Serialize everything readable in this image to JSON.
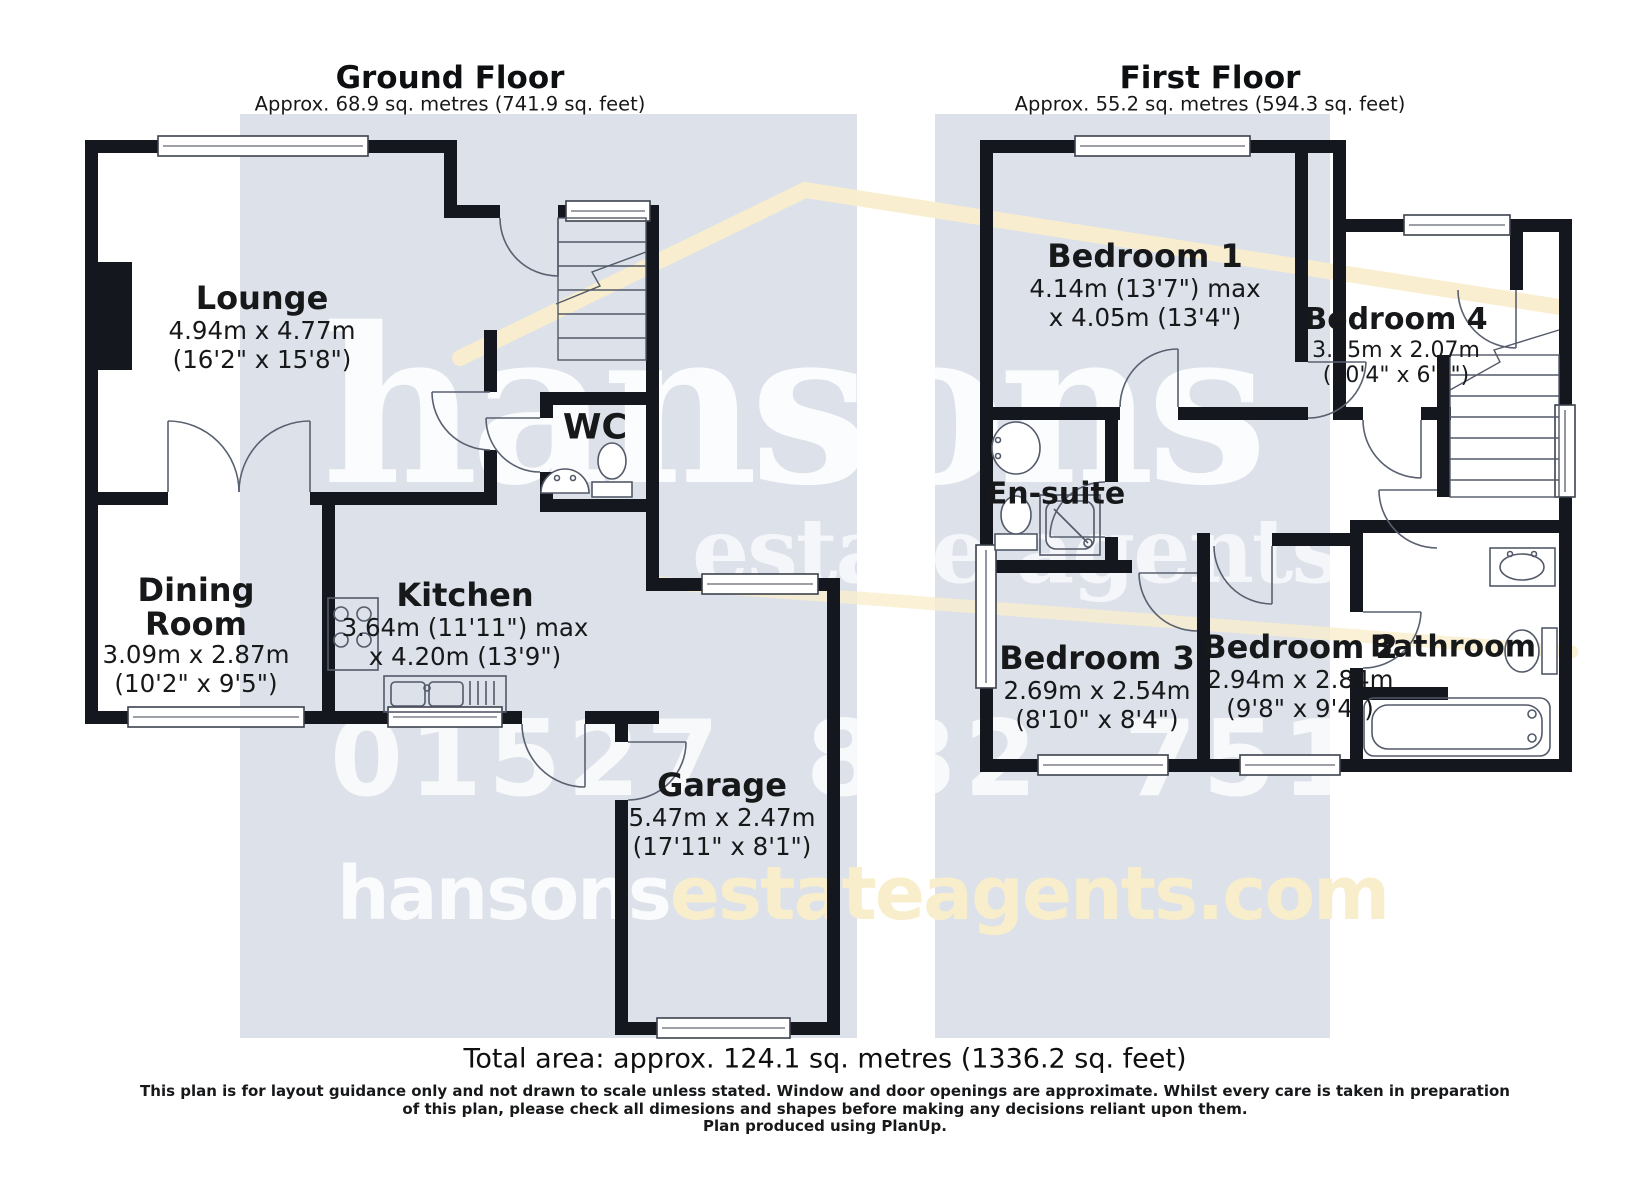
{
  "colors": {
    "wall": "#14171d",
    "plan_background": "#dce1ea",
    "watermark_cream": "#f9eecd",
    "watermark_white": "#ffffff",
    "text": "#17181a"
  },
  "watermark": {
    "brand": "hansons",
    "tagline": "estate agents",
    "phone": "01527 832 751",
    "website_prefix": "hansons",
    "website_suffix": "estateagents.com"
  },
  "ground_floor": {
    "title": "Ground Floor",
    "area": "Approx. 68.9 sq. metres (741.9 sq. feet)",
    "rooms": {
      "lounge": {
        "name": "Lounge",
        "metric": "4.94m x 4.77m",
        "imperial": "(16'2\" x 15'8\")"
      },
      "dining_room": {
        "name": "Dining Room",
        "metric": "3.09m x 2.87m",
        "imperial": "(10'2\" x 9'5\")"
      },
      "kitchen": {
        "name": "Kitchen",
        "metric": "3.64m (11'11\") max",
        "imperial": "x 4.20m (13'9\")"
      },
      "wc": {
        "name": "WC"
      },
      "garage": {
        "name": "Garage",
        "metric": "5.47m x 2.47m",
        "imperial": "(17'11\" x 8'1\")"
      }
    }
  },
  "first_floor": {
    "title": "First Floor",
    "area": "Approx. 55.2 sq. metres (594.3 sq. feet)",
    "rooms": {
      "bedroom1": {
        "name": "Bedroom 1",
        "metric": "4.14m (13'7\") max",
        "imperial": "x 4.05m (13'4\")"
      },
      "bedroom4": {
        "name": "Bedroom 4",
        "metric": "3.15m x 2.07m",
        "imperial": "(10'4\" x 6'9\")"
      },
      "ensuite": {
        "name": "En-suite"
      },
      "bedroom3": {
        "name": "Bedroom 3",
        "metric": "2.69m x 2.54m",
        "imperial": "(8'10\" x 8'4\")"
      },
      "bedroom2": {
        "name": "Bedroom 2",
        "metric": "2.94m x 2.84m",
        "imperial": "(9'8\" x 9'4\")"
      },
      "bathroom": {
        "name": "Bathroom"
      }
    }
  },
  "footer": {
    "total_area": "Total area: approx. 124.1 sq. metres (1336.2 sq. feet)",
    "disclaimer_line1": "This plan is for layout guidance only and not drawn to scale unless stated. Window and door openings are approximate. Whilst every care is taken in preparation",
    "disclaimer_line2": "of this plan, please check all dimesions and shapes before making any decisions reliant upon them.",
    "produced_by": "Plan produced using PlanUp."
  }
}
